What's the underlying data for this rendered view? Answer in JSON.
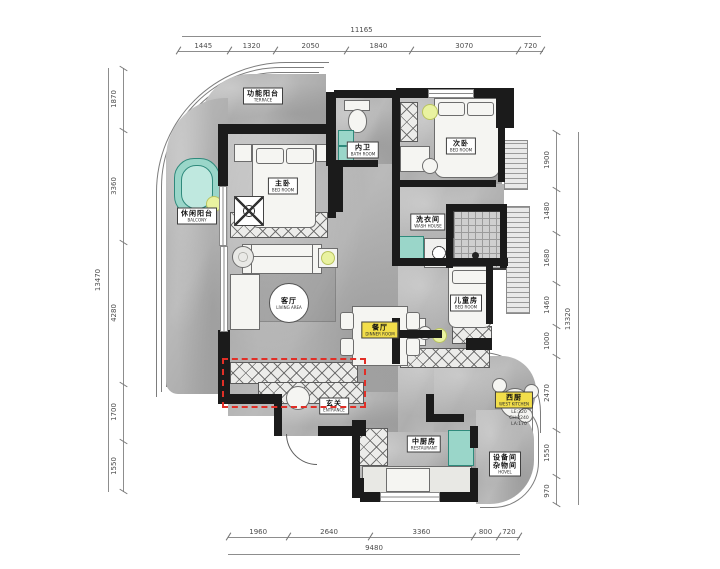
{
  "dimensions": {
    "top": {
      "overall": "11165",
      "segments": [
        "1445",
        "1320",
        "2050",
        "1840",
        "3070",
        "720"
      ]
    },
    "bottom": {
      "overall": "9480",
      "segments": [
        "1960",
        "2640",
        "3360",
        "800",
        "720"
      ]
    },
    "left": {
      "overall": "13470",
      "segments": [
        "1870",
        "3360",
        "4280",
        "1700",
        "1550"
      ]
    },
    "right": {
      "overall": "13320",
      "segments": [
        "1900",
        "1480",
        "1680",
        "1460",
        "1000",
        "2470",
        "1550",
        "970"
      ]
    }
  },
  "rooms": {
    "terrace": {
      "cn": "功能阳台",
      "en": "TERRACE"
    },
    "balcony": {
      "cn": "休闲阳台",
      "en": "BALCONY"
    },
    "master_bedroom": {
      "cn": "主卧",
      "en": "BED ROOM"
    },
    "bathroom": {
      "cn": "内卫",
      "en": "BATH ROOM"
    },
    "second_bedroom": {
      "cn": "次卧",
      "en": "BED ROOM"
    },
    "wash_house": {
      "cn": "洗衣间",
      "en": "WASH HOUSE"
    },
    "kids_room": {
      "cn": "儿童房",
      "en": "BED ROOM"
    },
    "living": {
      "cn": "客厅",
      "en": "LIVING AREA"
    },
    "dining": {
      "cn": "餐厅",
      "en": "DINNER ROOM"
    },
    "entrance": {
      "cn": "玄关",
      "en": "ENTRANCE"
    },
    "west_kitchen": {
      "cn": "西厨",
      "en": "WEST KITCHEN"
    },
    "kitchen": {
      "cn": "中厨房",
      "en": "RESTAURANT"
    },
    "utility": {
      "cn": "设备间",
      "cn2": "杂物间",
      "en": "HOVEL"
    }
  },
  "notes": {
    "line1": "LE:320",
    "line2": "CH:2240",
    "line3": "LA:170"
  },
  "colors": {
    "wall": "#1b1b1b",
    "floor": "#b2b2b2",
    "highlight_red": "#e12f27",
    "label_accent_yellow": "#f2de4a",
    "fixture_teal": "#9ad6c9",
    "light_yellow_green": "#e9f2a0"
  }
}
